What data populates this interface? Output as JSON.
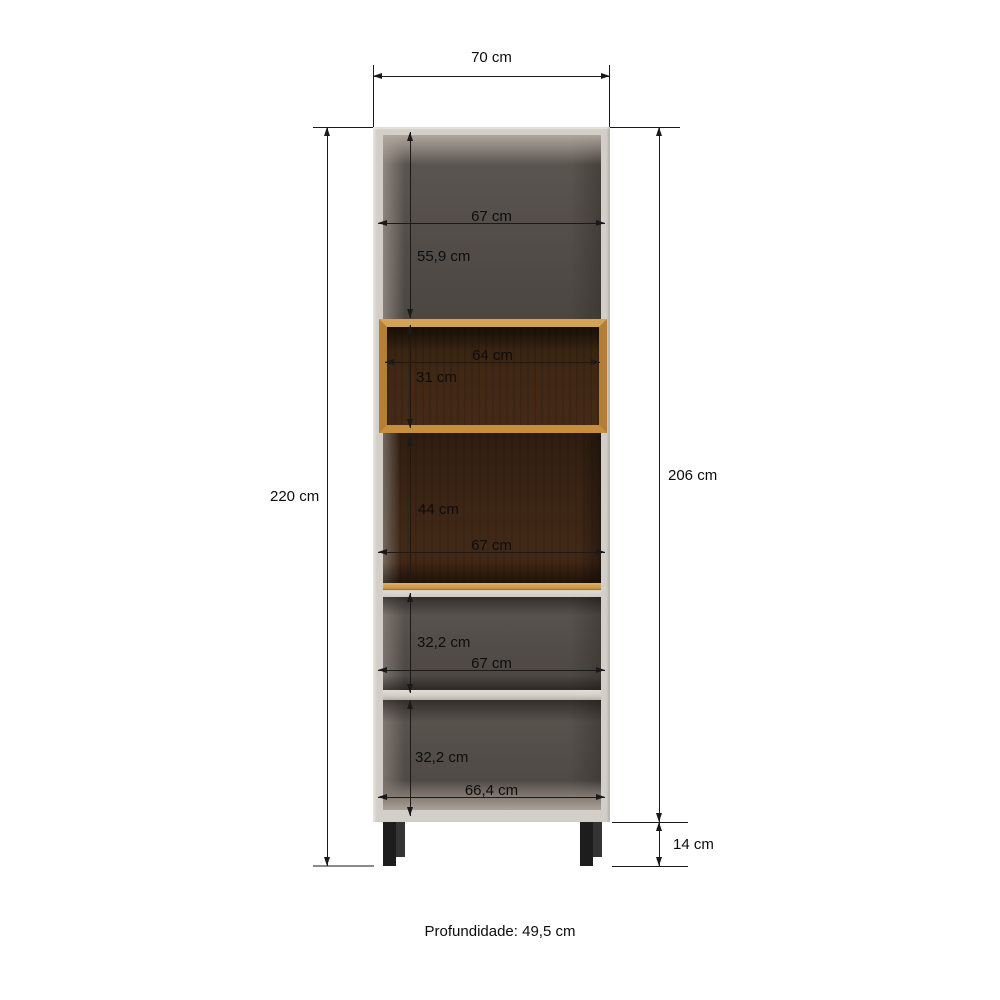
{
  "diagram": {
    "type": "furniture-dimension-diagram",
    "footer": "Profundidade: 49,5 cm",
    "overall": {
      "top_width": "70 cm",
      "total_height": "220 cm",
      "body_height": "206 cm",
      "leg_height": "14 cm"
    },
    "interior": {
      "top_opening_width": "67 cm",
      "top_opening_height": "55,9 cm",
      "niche_width": "64 cm",
      "niche_height": "31 cm",
      "middle_opening_height": "44 cm",
      "middle_opening_width": "67 cm",
      "upper_shelf_opening_height": "32,2 cm",
      "upper_shelf_opening_width": "67 cm",
      "lower_shelf_opening_height": "32,2 cm",
      "bottom_opening_width": "66,4 cm"
    },
    "colors": {
      "background": "#ffffff",
      "body_exterior": "#d3cfc8",
      "interior_gray": "#544f4b",
      "oak_wood": "#cf9a4a",
      "walnut_wood": "#3a2414",
      "legs": "#1d1d1d",
      "dimension_lines": "#1a1a1a"
    }
  }
}
